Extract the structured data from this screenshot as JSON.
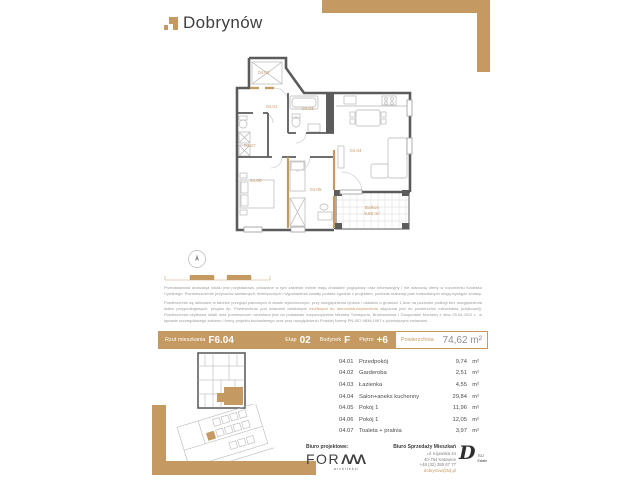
{
  "colors": {
    "gold": "#c49a62",
    "wall_gray": "#5b5b5b",
    "text_dark": "#3e3e3e",
    "muted_gray": "#8f8f8f"
  },
  "header": {
    "brand": "Dobrynów"
  },
  "plan": {
    "labels": {
      "r1": "04.01",
      "r2": "04.02",
      "r3": "04.03",
      "r4": "04.04",
      "r5": "04.05",
      "r6": "04.06",
      "r7": "04.07"
    },
    "balcony_label": "Balkon",
    "balcony_area": "8,80 m²"
  },
  "disclaimer": {
    "p1": "Przedstawiona aranżacja lokalu jest przykładowa, pokazane w tym zakresie meble mają charakter poglądowy oraz informacyjny i nie stanowią oferty w rozumieniu Kodeksu Cywilnego. Rozmieszczenie przyborów sanitarnych, elektrycznych i wyposażenia zostały podane zgodnie z projektem, podczas realizacji prac budowlanych mogą wystąpić zmiany.",
    "p2a": "Powierzchnie są obliczane w tabelce przegląd planowych w stanie wykończonym, przy uwzględnieniu tynków i okładzin o grubości 1,5cm na poziomie podłogi bez uwzględnienia listew przypodłogowych, progów itp. Powierzchnia pod ścianami działowymi ",
    "p2_highlight": "możliwymi do demontażu/wyburzenia",
    "p2b": " włączona jest do powierzchni mieszkania (użytkowej). Powierzchnia użytkowa lokali oraz pomieszczeń określona jest na podstawie rozporządzenia Ministra Transportu, Budownictwa i Gospodarki Morskiej z dnia 25.04.2012 r., w sprawie szczegółowego zakresu i formy projektu budowlanego oraz przy uwzględnieniu Polskiej Normy PN-ISO 9836:1997 z późniejszymi zmianami."
  },
  "info_bar": {
    "plan_label": "Rzut mieszkania",
    "plan_value": "F6.04",
    "stage_label": "Etap",
    "stage_value": "02",
    "building_label": "Budynek",
    "building_value": "F",
    "floor_label": "Piętro",
    "floor_value": "+6",
    "area_label": "Powierzchnia",
    "area_value": "74,62 m²"
  },
  "rooms": [
    {
      "no": "04.01",
      "name": "Przedpokój",
      "area": "9,74",
      "unit": "m²"
    },
    {
      "no": "04.02",
      "name": "Garderoba",
      "area": "2,51",
      "unit": "m²"
    },
    {
      "no": "04.03",
      "name": "Łazienka",
      "area": "4,55",
      "unit": "m²"
    },
    {
      "no": "04.04",
      "name": "Salon+aneks kuchenny",
      "area": "29,84",
      "unit": "m²"
    },
    {
      "no": "04.05",
      "name": "Pokój 1",
      "area": "11,96",
      "unit": "m²"
    },
    {
      "no": "04.06",
      "name": "Pokój 1",
      "area": "12,05",
      "unit": "m²"
    },
    {
      "no": "04.07",
      "name": "Toaleta + pralnia",
      "area": "3,97",
      "unit": "m²"
    }
  ],
  "footer": {
    "design_office_label": "Biuro projektowe:",
    "forma_text": "FOR",
    "forma_peaks": "ΛΛΛ",
    "forma_sub": "architekci",
    "sales_title": "Biuro Sprzedaży Mieszkań",
    "sales_line1": "ul. Kijowska 44",
    "sales_line2": "40-754 Katowice",
    "sales_line3": "+48 (32) 359 67 77",
    "sales_line4": "dobrynow@tdj.pl",
    "tdj_name": "TDJ",
    "tdj_sub": "Estate"
  }
}
